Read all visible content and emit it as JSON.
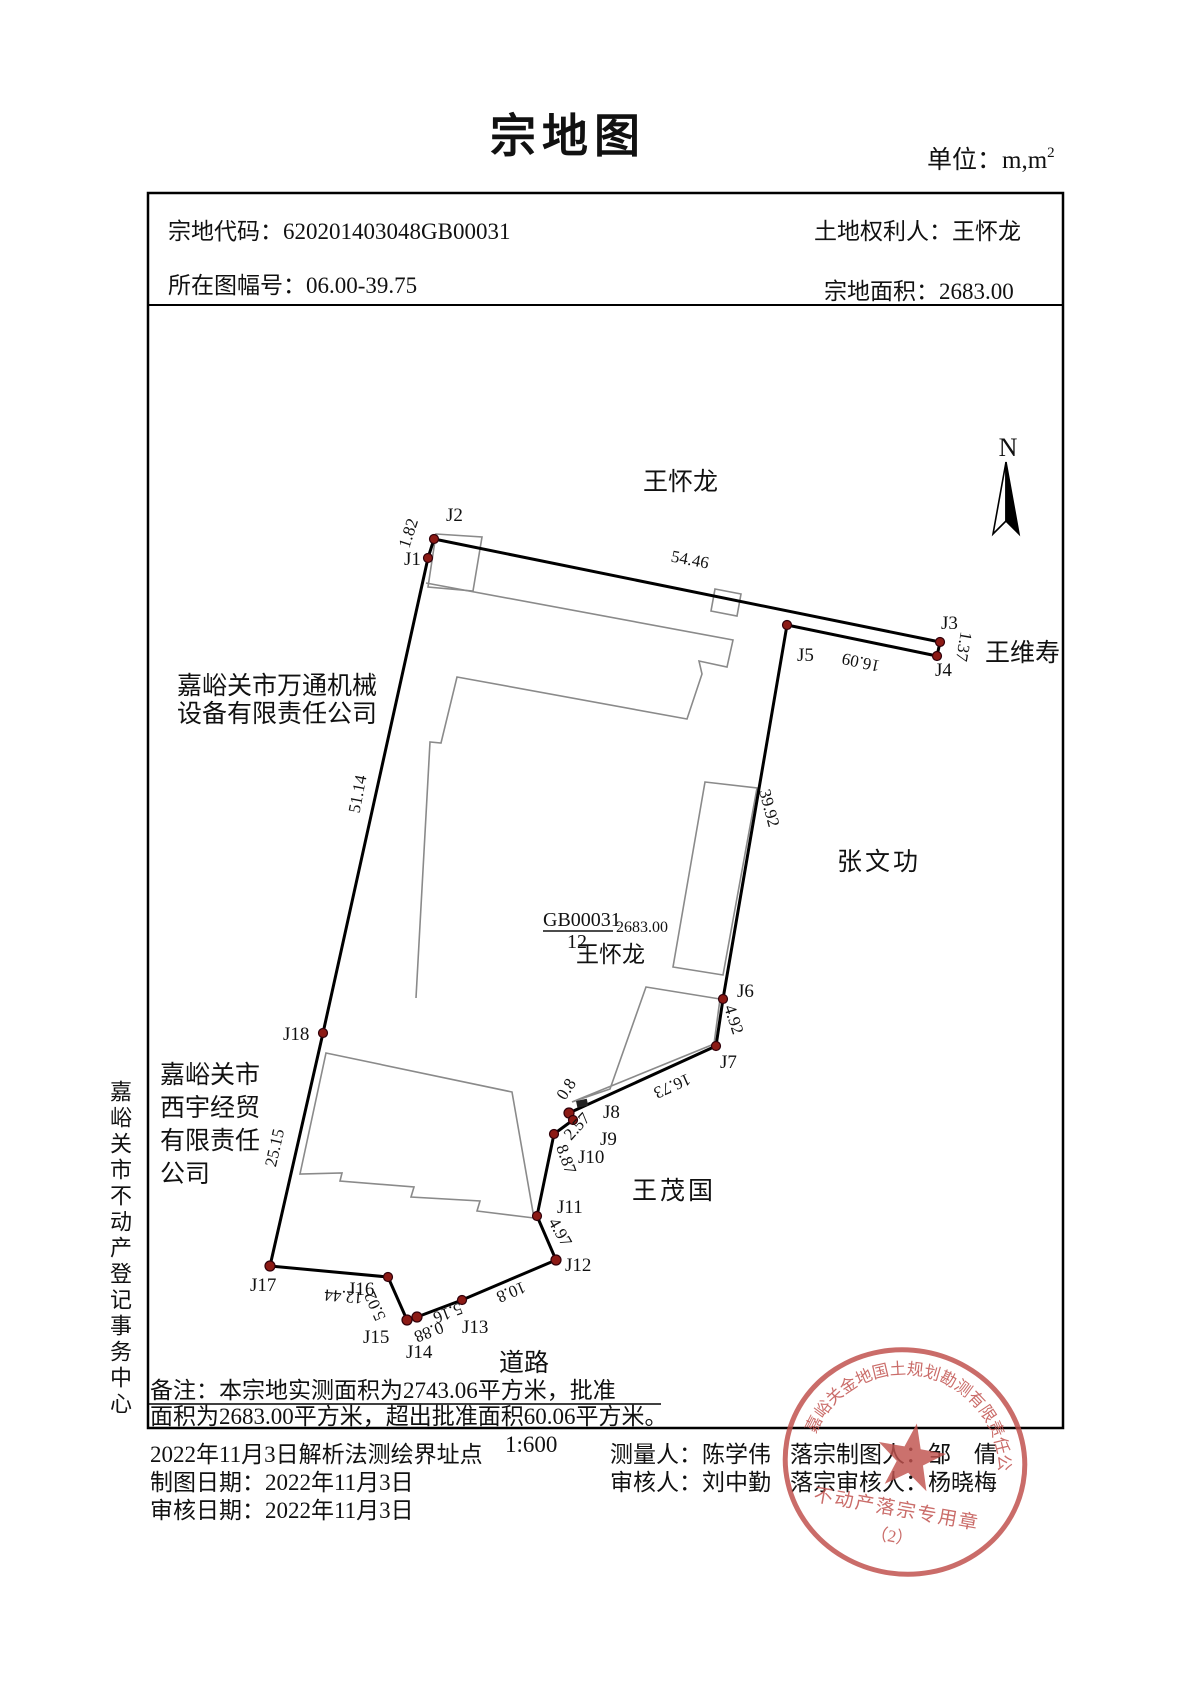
{
  "title": "宗地图",
  "unit_label": "单位：m,m",
  "unit_sup": "2",
  "header": {
    "parcel_code_label": "宗地代码：",
    "parcel_code": "620201403048GB00031",
    "owner_label": "土地权利人：",
    "owner": "王怀龙",
    "map_sheet_label": "所在图幅号：",
    "map_sheet": "06.00-39.75",
    "area_label": "宗地面积：",
    "area": "2683.00"
  },
  "map": {
    "north_label": "N",
    "parcel_label": {
      "code": "GB00031",
      "number": "12",
      "area": "2683.00",
      "owner": "王怀龙"
    },
    "neighbors": {
      "top": "王怀龙",
      "right_top": "王维寿",
      "right": "张文功",
      "bottom_right": "王茂国",
      "road": "道路",
      "left_company_line1": "嘉峪关市万通机械",
      "left_company_line2": "设备有限责任公司",
      "left2_line1": "嘉峪关市",
      "left2_line2": "西宇经贸",
      "left2_line3": "有限责任",
      "left2_line4": "公司"
    },
    "point_labels": [
      "J1",
      "J2",
      "J3",
      "J4",
      "J5",
      "J6",
      "J7",
      "J8",
      "J9",
      "J10",
      "J11",
      "J12",
      "J13",
      "J14",
      "J15",
      "J16",
      "J17",
      "J18"
    ],
    "distances": {
      "j1_j2": "1.82",
      "j2_j3": "54.46",
      "j3_j4": "1.37",
      "j4_j5": "16.09",
      "j5_j6": "39.92",
      "j6_j7": "4.92",
      "j7_j8": "16.73",
      "j8_j9": "0.8",
      "j9_j10": "2.57",
      "j10_j11": "8.87",
      "j11_j12": "4.97",
      "j12_j13": "10.8",
      "j13_j14": "5.16",
      "j14_j15": "0.88",
      "j15_j16": "5.02",
      "j16_j17": "12.44",
      "j17_j18": "25.15",
      "j18_j1": "51.14"
    }
  },
  "notes": {
    "line1": "备注：本宗地实测面积为2743.06平方米，批准",
    "line2": "面积为2683.00平方米，超出批准面积60.06平方米。"
  },
  "footer": {
    "scale": "1:600",
    "survey_note": "2022年11月3日解析法测绘界址点",
    "draw_date": "制图日期：2022年11月3日",
    "review_date": "审核日期：2022年11月3日",
    "surveyor": "测量人：陈学伟",
    "reviewer": "审核人：刘中勤",
    "record_drafter": "落宗制图人：邹　倩",
    "record_reviewer": "落宗审核人：杨晓梅"
  },
  "seal": {
    "company": "嘉峪关金地国土规划勘测有限责任公司",
    "purpose": "不动产落宗专用章",
    "number": "（2）"
  },
  "side_label": "嘉峪关市不动产登记事务中心"
}
